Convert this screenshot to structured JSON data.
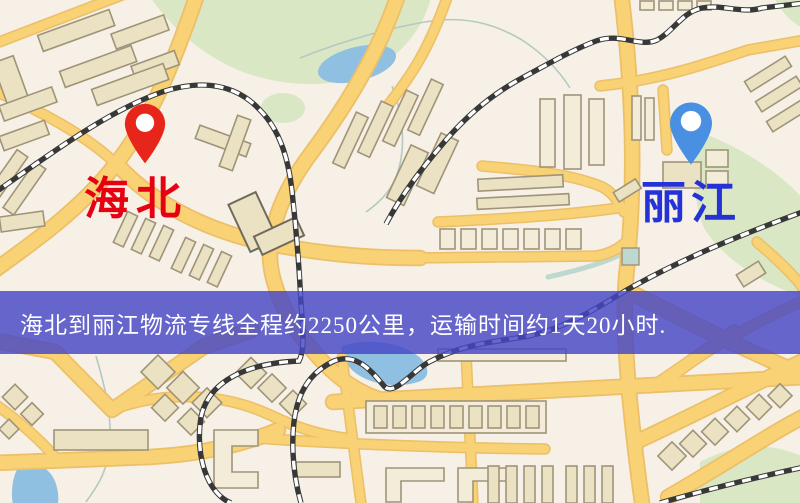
{
  "map": {
    "origin": {
      "name": "海北",
      "marker_icon": "red-location-pin"
    },
    "destination": {
      "name": "丽江",
      "marker_icon": "blue-location-pin"
    }
  },
  "banner": {
    "text": "海北到丽江物流专线全程约2250公里，运输时间约1天20小时."
  },
  "colors": {
    "map-bg": "#f6f0e6",
    "road": "#f8d274",
    "road-edge": "#ecbf68",
    "building": "#ebe1c3",
    "building-light": "#f2ecd9",
    "building-stroke": "#a09478",
    "building-dark-stroke": "#6f6a5c",
    "park": "#d9e7c5",
    "water": "#8fc0e1",
    "pond": "#bcd8d0",
    "stream": "#b6c9c0",
    "rail-dark": "#383838",
    "rail-light": "#ffffff",
    "pin-red": "#e8251a",
    "pin-blue": "#4a90e2",
    "label-red": "#e60012",
    "label-blue": "#2433d6",
    "banner-bg": "rgba(70,70,198,0.82)",
    "banner-text": "#ffffff"
  }
}
